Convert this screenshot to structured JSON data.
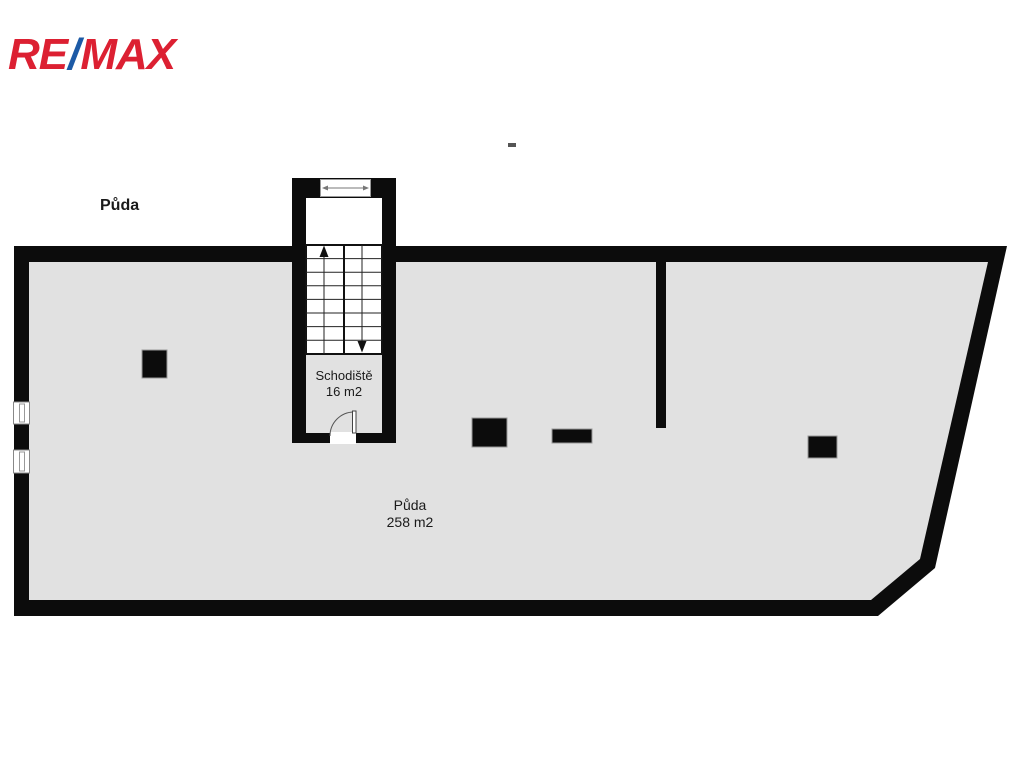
{
  "logo": {
    "re": "RE",
    "slash": "/",
    "max": "MAX",
    "red": "#DC2032",
    "blue": "#1C5AA6"
  },
  "colors": {
    "wall": "#0c0c0c",
    "floor": "#e1e1e1",
    "white": "#ffffff",
    "thin_line": "#222222",
    "symbol_gray": "#777777"
  },
  "labels": {
    "attic_title": "Půda",
    "staircase_room": {
      "name": "Schodiště",
      "area": "16 m2"
    },
    "attic_room": {
      "name": "Půda",
      "area": "258 m2"
    }
  }
}
